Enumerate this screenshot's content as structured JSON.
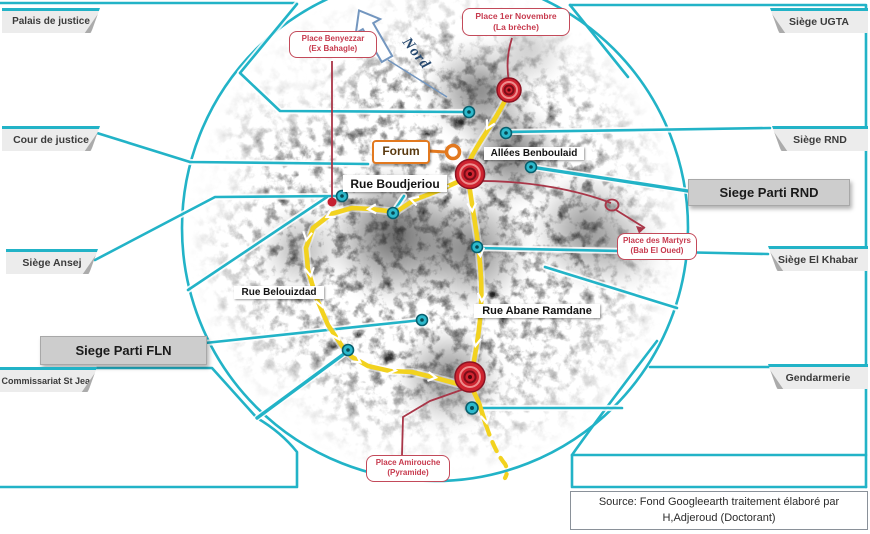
{
  "colors": {
    "teal": "#22b3c7",
    "yellow": "#f2d21f",
    "red_marker": "#cf2430",
    "red_annotation": "#c73a4e",
    "orange": "#e2791f",
    "tab_bg": "#ececec",
    "box_bg": "#cdcdcd",
    "nord_blue": "#24476e"
  },
  "left_callouts": [
    {
      "id": "palais",
      "label": "Palais de justice"
    },
    {
      "id": "cour",
      "label": "Cour de justice"
    },
    {
      "id": "ansej",
      "label": "Siège Ansej"
    },
    {
      "id": "fln",
      "label": "Siege Parti FLN"
    },
    {
      "id": "commissariat",
      "label": "Commissariat St Jean"
    }
  ],
  "right_callouts": [
    {
      "id": "ugta",
      "label": "Siège UGTA"
    },
    {
      "id": "rnd",
      "label": "Siège RND"
    },
    {
      "id": "parti_rnd",
      "label": "Siege Parti RND"
    },
    {
      "id": "khabar",
      "label": "Siège El Khabar"
    },
    {
      "id": "gendarmerie",
      "label": "Gendarmerie"
    }
  ],
  "map_labels": {
    "forum": "Forum",
    "streets": [
      {
        "id": "benboulaid",
        "label": "Allées Benboulaid"
      },
      {
        "id": "boudjeriou",
        "label": "Rue Boudjeriou"
      },
      {
        "id": "belouizdad",
        "label": "Rue Belouizdad"
      },
      {
        "id": "abane",
        "label": "Rue Abane Ramdane"
      }
    ]
  },
  "places": [
    {
      "id": "benyezzar",
      "line1": "Place Benyezzar",
      "line2": "(Ex Bahagle)"
    },
    {
      "id": "novembre",
      "line1": "Place 1er Novembre",
      "line2": "(La brèche)"
    },
    {
      "id": "martyrs",
      "line1": "Place des Martyrs",
      "line2": "(Bab El Oued)"
    },
    {
      "id": "amirouche",
      "line1": "Place Amirouche",
      "line2": "(Pyramide)"
    }
  ],
  "north_label": "Nord",
  "source": {
    "line1": "Source: Fond Googleearth  traitement élaboré par",
    "line2": "H,Adjeroud (Doctorant)"
  }
}
